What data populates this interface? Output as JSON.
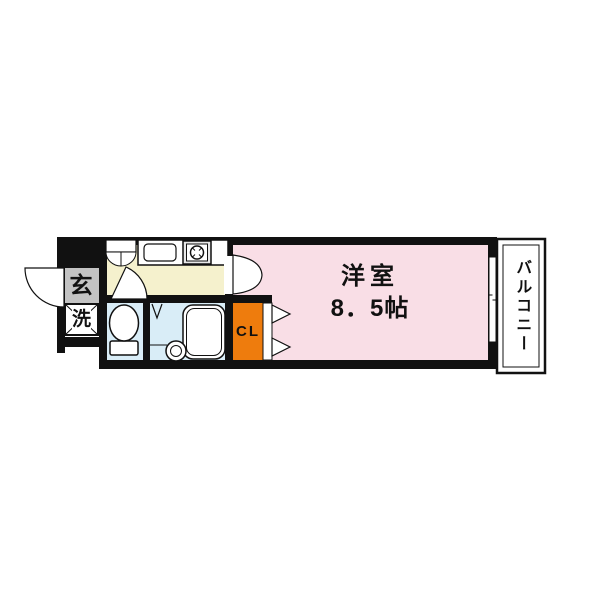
{
  "floor_plan": {
    "background": "#ffffff",
    "wall_color": "#111111",
    "rooms": {
      "main_room": {
        "name": "洋室",
        "size": "8．5帖",
        "fill": "#f9dee6"
      },
      "kitchen": {
        "fill": "#f5f1cd"
      },
      "entrance": {
        "label": "玄",
        "fill": "#c3c3c3"
      },
      "laundry": {
        "label": "洗",
        "fill": "#ffffff"
      },
      "closet": {
        "label": "CL",
        "fill": "#ee7c0d"
      },
      "toilet": {
        "fill": "#d9edf7"
      },
      "bathroom": {
        "fill": "#d9edf7"
      },
      "balcony": {
        "label": "バルコニー",
        "fill": "#ffffff"
      }
    }
  }
}
